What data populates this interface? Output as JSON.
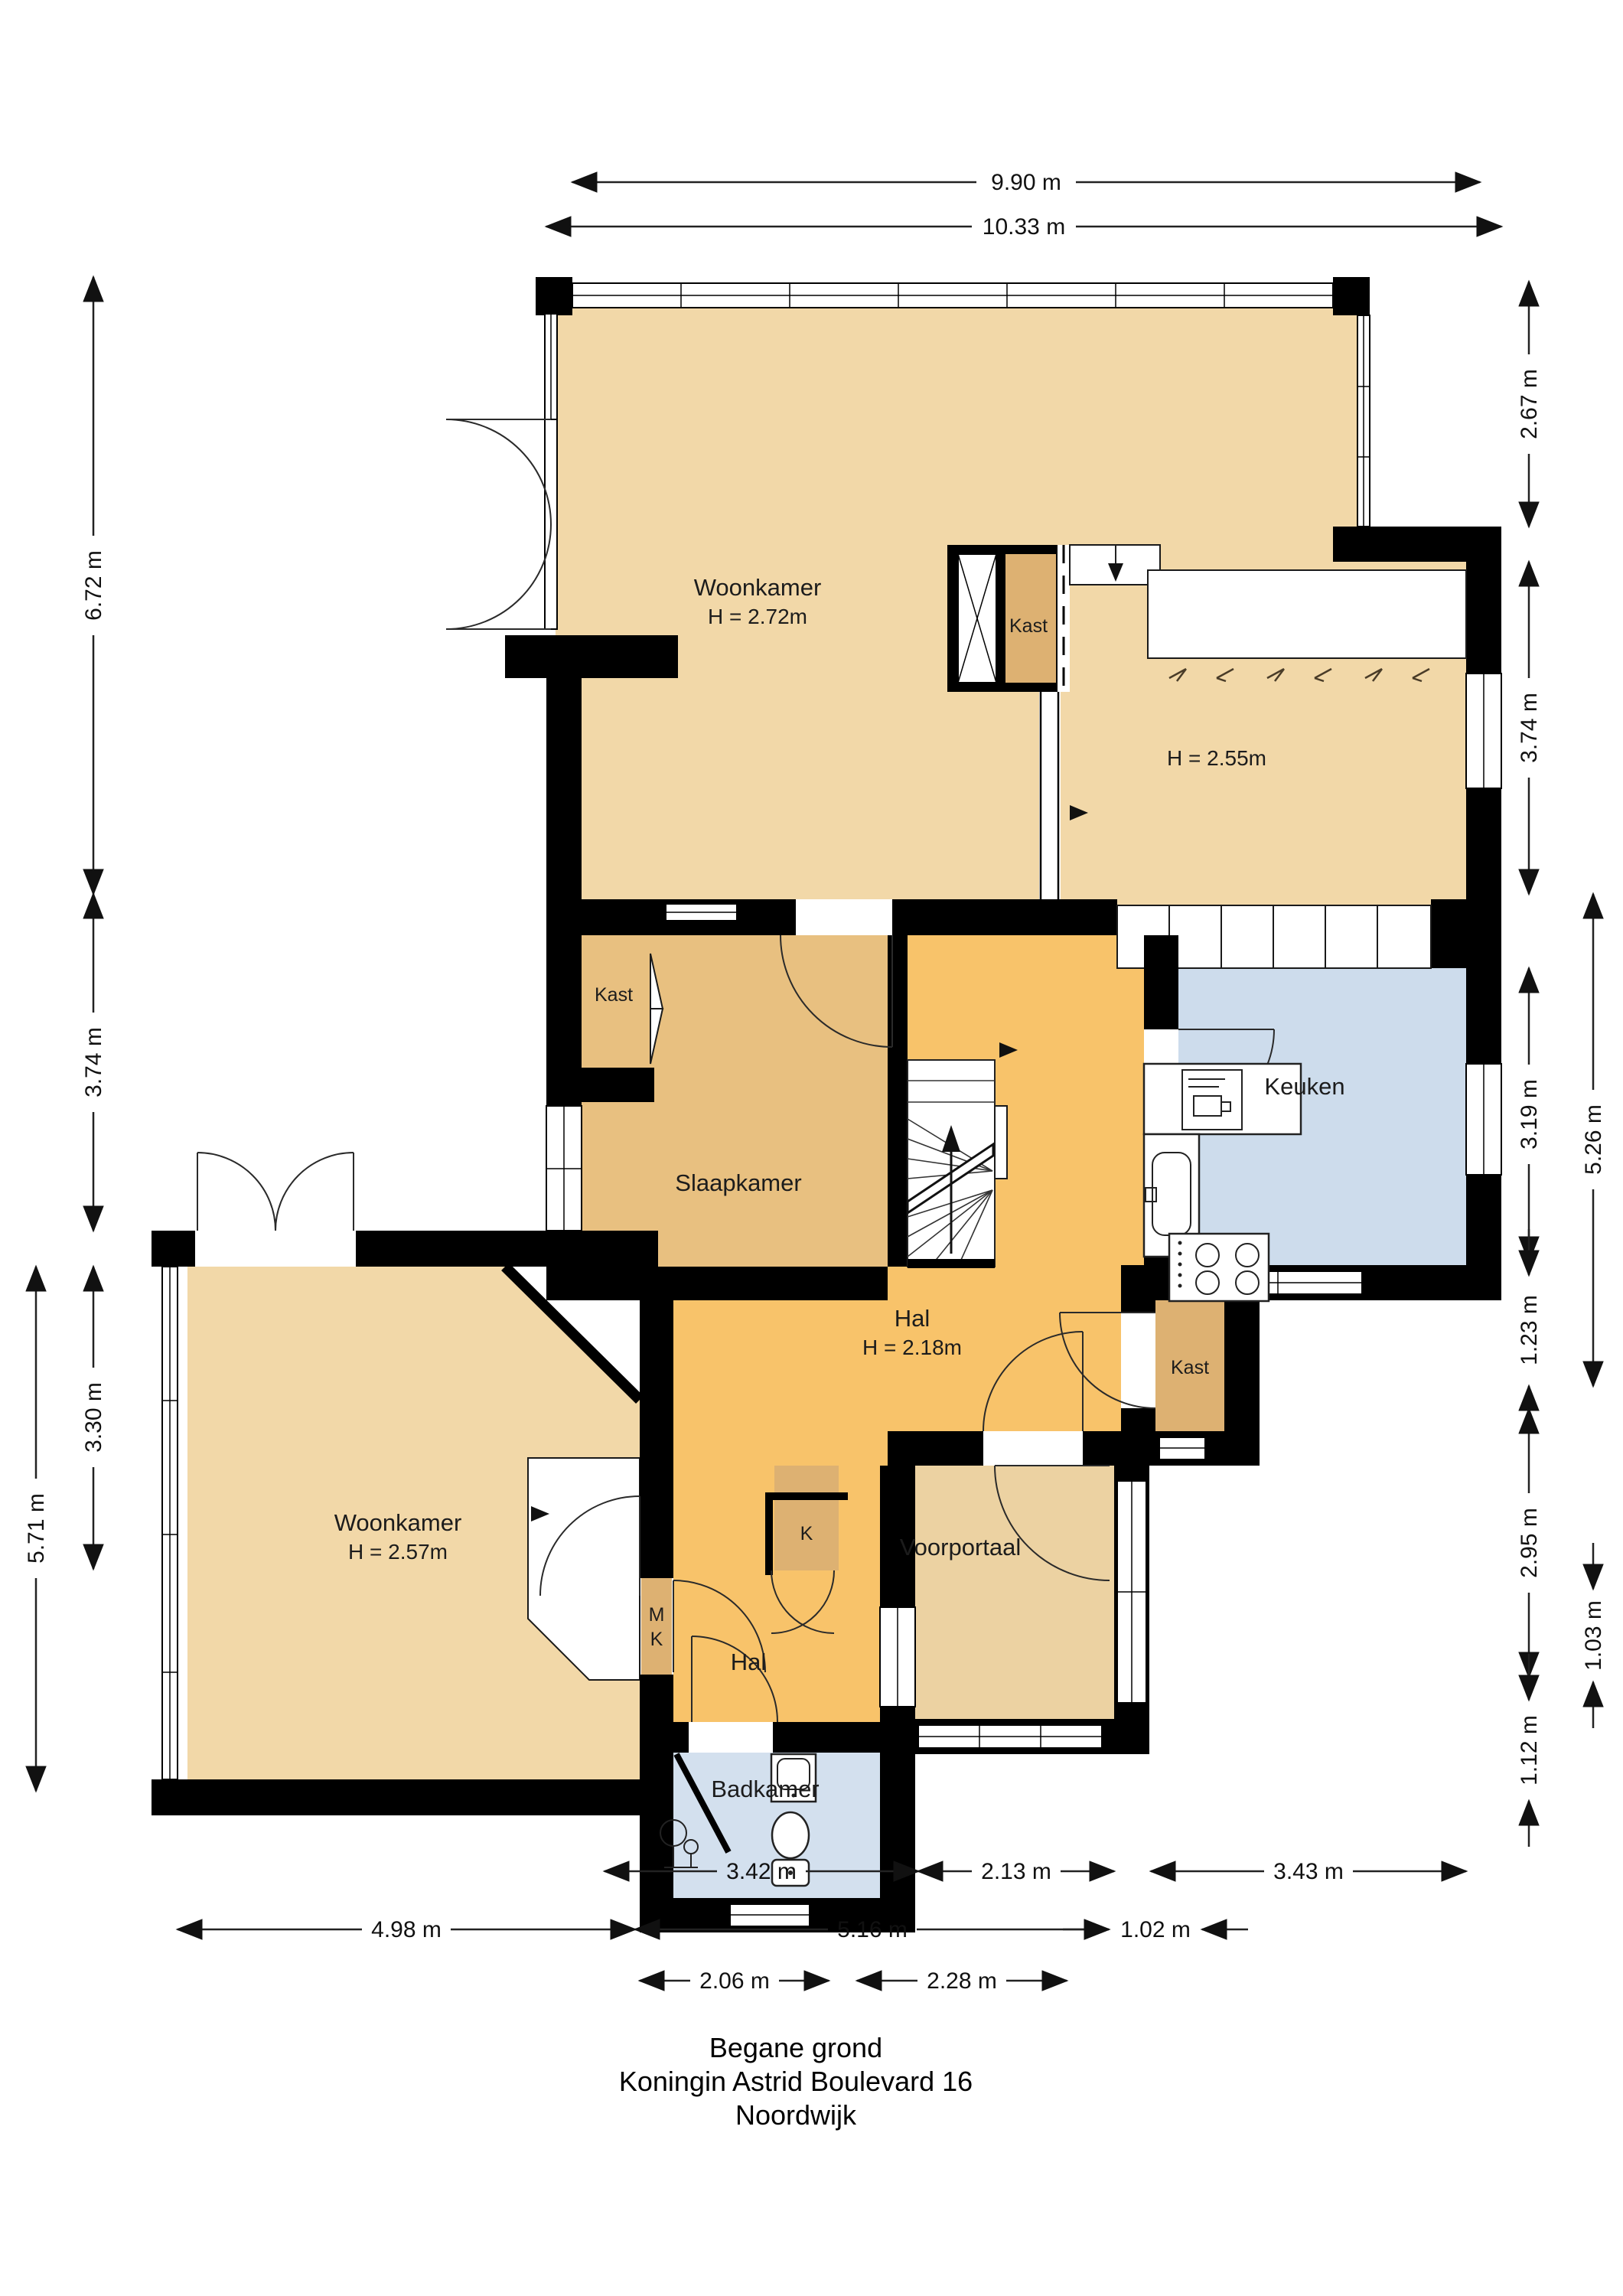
{
  "title": {
    "floor": "Begane grond",
    "address": "Koningin Astrid Boulevard 16",
    "city": "Noordwijk"
  },
  "rooms": {
    "woonkamer_top": {
      "name": "Woonkamer",
      "height": "H = 2.72m"
    },
    "area_right": {
      "height": "H = 2.55m"
    },
    "kast_top": {
      "name": "Kast"
    },
    "kast_left": {
      "name": "Kast"
    },
    "slaapkamer": {
      "name": "Slaapkamer"
    },
    "keuken": {
      "name": "Keuken"
    },
    "hal": {
      "name": "Hal",
      "height": "H = 2.18m"
    },
    "kast_hal": {
      "name": "Kast"
    },
    "woonkamer_bottom": {
      "name": "Woonkamer",
      "height": "H = 2.57m"
    },
    "k_closet": {
      "name": "K"
    },
    "mk_closet": {
      "line1": "M",
      "line2": "K"
    },
    "hal_small": {
      "name": "Hal"
    },
    "voorportaal": {
      "name": "Voorportaal"
    },
    "badkamer": {
      "name": "Badkamer"
    }
  },
  "dimensions": {
    "w_top_inner": "9.90 m",
    "w_top_outer": "10.33 m",
    "l1": "6.72 m",
    "l2": "3.74 m",
    "l3": "3.30 m",
    "l4": "5.71 m",
    "r1": "2.67 m",
    "r2": "3.74 m",
    "r3": "3.19 m",
    "r4": "5.26 m",
    "r5": "1.23 m",
    "r6": "2.95 m",
    "r7": "1.03 m",
    "r8": "1.12 m",
    "b1": "3.42 m",
    "b2": "2.13 m",
    "b3": "3.43 m",
    "b4": "4.98 m",
    "b5": "5.16 m",
    "b6": "1.02 m",
    "b7": "2.06 m",
    "b8": "2.28 m"
  },
  "colors": {
    "wall": "#000000",
    "woonkamer": "#f2d8a8",
    "slaapkamer": "#e8c080",
    "kast": "#ddb172",
    "hal": "#f8c36a",
    "keuken": "#cddcec",
    "badkamer": "#d3e0ee",
    "voorportaal": "#ecd2a2"
  }
}
